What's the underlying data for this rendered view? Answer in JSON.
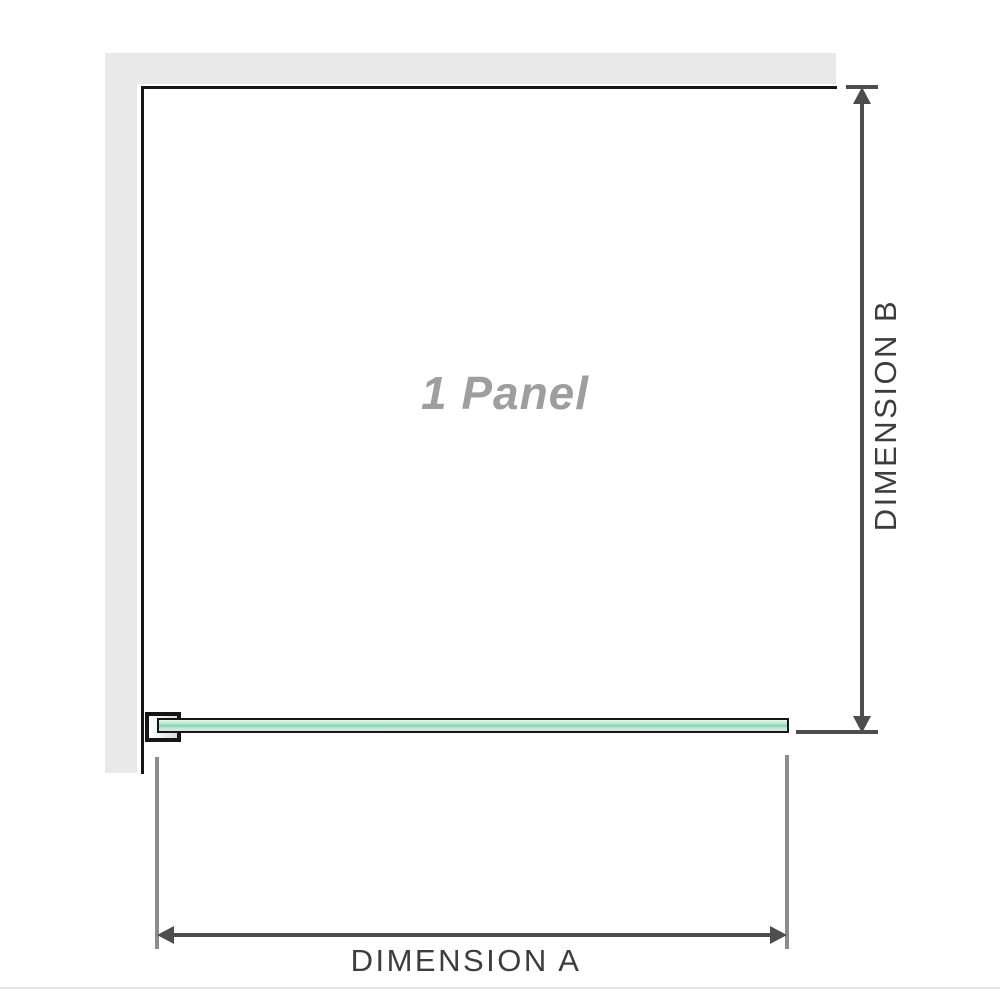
{
  "diagram": {
    "panel_label": "1 Panel",
    "dimension_a": {
      "label": "DIMENSION A"
    },
    "dimension_b": {
      "label": "DIMENSION B"
    }
  },
  "colors": {
    "background": "#ffffff",
    "wall": "#e9e9e9",
    "outline": "#161616",
    "glass_mid": "#84cca8",
    "dim_line": "#4d4d4d",
    "ext_line": "#8c8c8c",
    "dim_text": "#3d3d3d",
    "panel_text": "#9e9e9e",
    "border_line": "#e3e3e0"
  }
}
